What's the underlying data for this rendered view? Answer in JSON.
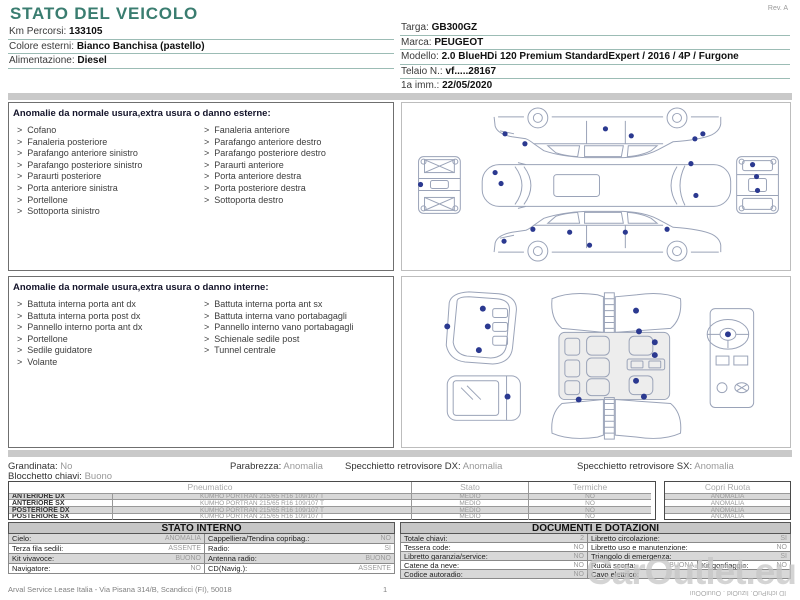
{
  "header": {
    "title": "STATO DEL VEICOLO",
    "rev": "Rev. A",
    "left_fields": [
      {
        "label": "Km Percorsi:",
        "value": "133105"
      },
      {
        "label": "Colore esterni:",
        "value": "Bianco Banchisa (pastello)"
      },
      {
        "label": "Alimentazione:",
        "value": "Diesel"
      }
    ],
    "right_fields": [
      {
        "label": "Targa:",
        "value": "GB300GZ"
      },
      {
        "label": "Marca:",
        "value": "PEUGEOT"
      },
      {
        "label": "Modello:",
        "value": "2.0 BlueHDi 120 Premium StandardExpert / 2016 / 4P / Furgone"
      },
      {
        "label": "Telaio N.:",
        "value": "vf.....28167"
      },
      {
        "label": "1a imm.:",
        "value": "22/05/2020"
      }
    ]
  },
  "exterior": {
    "heading": "Anomalie da normale usura,extra usura o danno esterne:",
    "col1": [
      "Cofano",
      "Fanaleria posteriore",
      "Parafango anteriore sinistro",
      "Parafango posteriore sinistro",
      "Paraurti posteriore",
      "Porta anteriore sinistra",
      "Portellone",
      "Sottoporta sinistro"
    ],
    "col2": [
      "Fanaleria anteriore",
      "Parafango anteriore destro",
      "Parafango posteriore destro",
      "Paraurti anteriore",
      "Porta anteriore destra",
      "Porta posteriore destra",
      "Sottoporta destro"
    ]
  },
  "interior": {
    "heading": "Anomalie da normale usura,extra usura o danno interne:",
    "col1": [
      "Battuta interna porta ant dx",
      "Battuta interna porta post dx",
      "Pannello interno porta ant dx",
      "Portellone",
      "Sedile guidatore",
      "Volante"
    ],
    "col2": [
      "Battuta interna porta ant sx",
      "Battuta interna vano portabagagli",
      "Pannello interno vano portabagagli",
      "Schienale sedile post",
      "Tunnel centrale"
    ]
  },
  "conditions": {
    "items": [
      {
        "label": "Grandinata:",
        "value": "No"
      },
      {
        "label": "Parabrezza:",
        "value": "Anomalia"
      },
      {
        "label": "Specchietto retrovisore DX:",
        "value": "Anomalia"
      },
      {
        "label": "Specchietto retrovisore SX:",
        "value": "Anomalia"
      }
    ],
    "row2": {
      "label": "Blocchetto chiavi:",
      "value": "Buono"
    }
  },
  "tires": {
    "headers": {
      "pneumatico": "Pneumatico",
      "stato": "Stato",
      "termiche": "Termiche",
      "copri": "Copri Ruota"
    },
    "rows": [
      {
        "pos": "ANTERIORE DX",
        "tire": "KUMHO PORTRAN 215/65 R16 109/107 T",
        "stato": "MEDIO",
        "termiche": "NO",
        "copri": "ANOMALIA"
      },
      {
        "pos": "ANTERIORE SX",
        "tire": "KUMHO PORTRAN 215/65 R16 109/107 T",
        "stato": "MEDIO",
        "termiche": "NO",
        "copri": "ANOMALIA"
      },
      {
        "pos": "POSTERIORE DX",
        "tire": "KUMHO PORTRAN 215/65 R16 109/107 T",
        "stato": "MEDIO",
        "termiche": "NO",
        "copri": "ANOMALIA"
      },
      {
        "pos": "POSTERIORE SX",
        "tire": "KUMHO PORTRAN 215/65 R16 109/107 T",
        "stato": "MEDIO",
        "termiche": "NO",
        "copri": "ANOMALIA"
      }
    ]
  },
  "stato_interno": {
    "title": "STATO INTERNO",
    "rows": [
      {
        "l1": "Cielo:",
        "v1": "ANOMALIA",
        "l2": "Cappelliera/Tendina copribag.:",
        "v2": "NO"
      },
      {
        "l1": "Terza fila sedili:",
        "v1": "ASSENTE",
        "l2": "Radio:",
        "v2": "SI"
      },
      {
        "l1": "Kit vivavoce:",
        "v1": "BUONO",
        "l2": "Antenna radio:",
        "v2": "BUONO"
      },
      {
        "l1": "Navigatore:",
        "v1": "NO",
        "l2": "CD(Navig.):",
        "v2": "ASSENTE"
      }
    ]
  },
  "documenti": {
    "title": "DOCUMENTI E DOTAZIONI",
    "rows": [
      {
        "l1": "Totale chiavi:",
        "v1": "2",
        "l2": "Libretto circolazione:",
        "v2": "SI"
      },
      {
        "l1": "Tessera code:",
        "v1": "NO",
        "l2": "Libretto uso e manutenzione:",
        "v2": "NO"
      },
      {
        "l1": "Libretto garanzia/service:",
        "v1": "NO",
        "l2": "Triangolo di emergenza:",
        "v2": "SI"
      }
    ],
    "special": {
      "l1": "Catene da neve:",
      "v1": "NO",
      "l2": "Ruota scorta:",
      "v2": "BUONA",
      "l3": "Kit gonfiaggio:",
      "v3": "NO"
    },
    "last": {
      "l1": "Codice autoradio:",
      "v1": "NO",
      "l2": "Cavo elettrico:",
      "v2": ""
    }
  },
  "footer": {
    "address": "Arval Service Lease Italia - Via Pisana 314/B, Scandicci (FI), 50018",
    "page": "1",
    "watermark": "CarOutlet.eu",
    "artifact": "ID ichiPuO. IizuOid . OuuiOOui"
  },
  "diagrams": {
    "dot_color": "#2b3990",
    "exterior_dots": [
      [
        103,
        31
      ],
      [
        123,
        41
      ],
      [
        204,
        26
      ],
      [
        230,
        33
      ],
      [
        294,
        36
      ],
      [
        302,
        31
      ],
      [
        18,
        82
      ],
      [
        93,
        70
      ],
      [
        99,
        81
      ],
      [
        290,
        61
      ],
      [
        295,
        93
      ],
      [
        352,
        62
      ],
      [
        356,
        74
      ],
      [
        357,
        88
      ],
      [
        131,
        127
      ],
      [
        168,
        130
      ],
      [
        224,
        130
      ],
      [
        266,
        127
      ],
      [
        102,
        139
      ],
      [
        188,
        143
      ]
    ],
    "interior_dots": [
      [
        80,
        32
      ],
      [
        85,
        50
      ],
      [
        44,
        50
      ],
      [
        76,
        74
      ],
      [
        105,
        121
      ],
      [
        235,
        34
      ],
      [
        238,
        55
      ],
      [
        254,
        66
      ],
      [
        254,
        79
      ],
      [
        235,
        105
      ],
      [
        243,
        121
      ],
      [
        177,
        124
      ],
      [
        328,
        58
      ]
    ]
  }
}
